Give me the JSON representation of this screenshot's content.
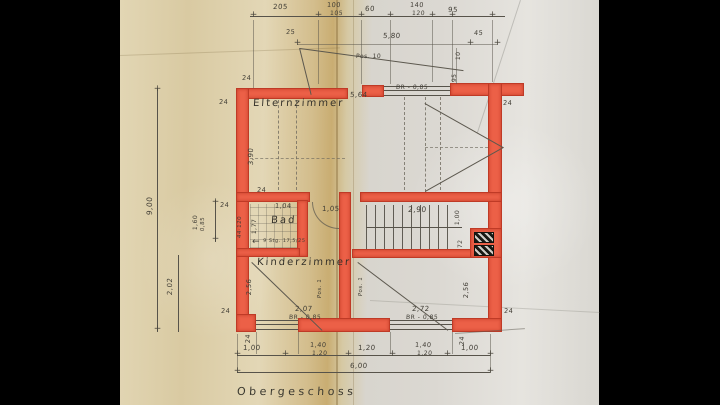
{
  "title": {
    "label": "Obergeschoss"
  },
  "rooms": {
    "parents": "Elternzimmer",
    "bath": "Bad",
    "kids": "Kinderzimmer"
  },
  "positions": {
    "pos10": "Pos. 10",
    "pos1": "Pos. 1"
  },
  "stair": {
    "note": "9 Stg. 17,5/25",
    "length": "2,90"
  },
  "windows": {
    "top": {
      "width": "5,64",
      "sill": "BR - 0,85"
    },
    "bottom_left": {
      "width": "2,07",
      "sill": "BR - 0,85"
    },
    "bottom_right": {
      "width": "2,72",
      "sill": "BR - 0,85"
    },
    "left": {
      "height": "1,60",
      "sill": "0,85",
      "note": "44·120"
    }
  },
  "dims": {
    "wall": "24",
    "top_row": {
      "a": "205",
      "b1": "100",
      "b2": "105",
      "c": "60",
      "d1": "140",
      "d2": "120",
      "e": "95"
    },
    "row2": {
      "a": "25",
      "b": "5,80",
      "c": "45",
      "d": "10",
      "e": "95"
    },
    "left": {
      "total": "9,00",
      "parents": "3,90",
      "bath": "1,77",
      "kids_a": "2,02",
      "kids_b": "2,56"
    },
    "right": {
      "a": "1,00",
      "b": "72",
      "c": "2,56"
    },
    "mid": {
      "bath": "1,04",
      "hall": "1,05"
    },
    "bottom_row": {
      "a": "1,00",
      "b1": "1,40",
      "b2": "1,20",
      "c": "1,20",
      "d1": "1,40",
      "d2": "1,20",
      "e": "1,00",
      "total": "6,00"
    }
  },
  "colors": {
    "wall_red": "#ec6047",
    "paper_tan": "#d9caa2",
    "paper_grey": "#dbd8d2"
  }
}
